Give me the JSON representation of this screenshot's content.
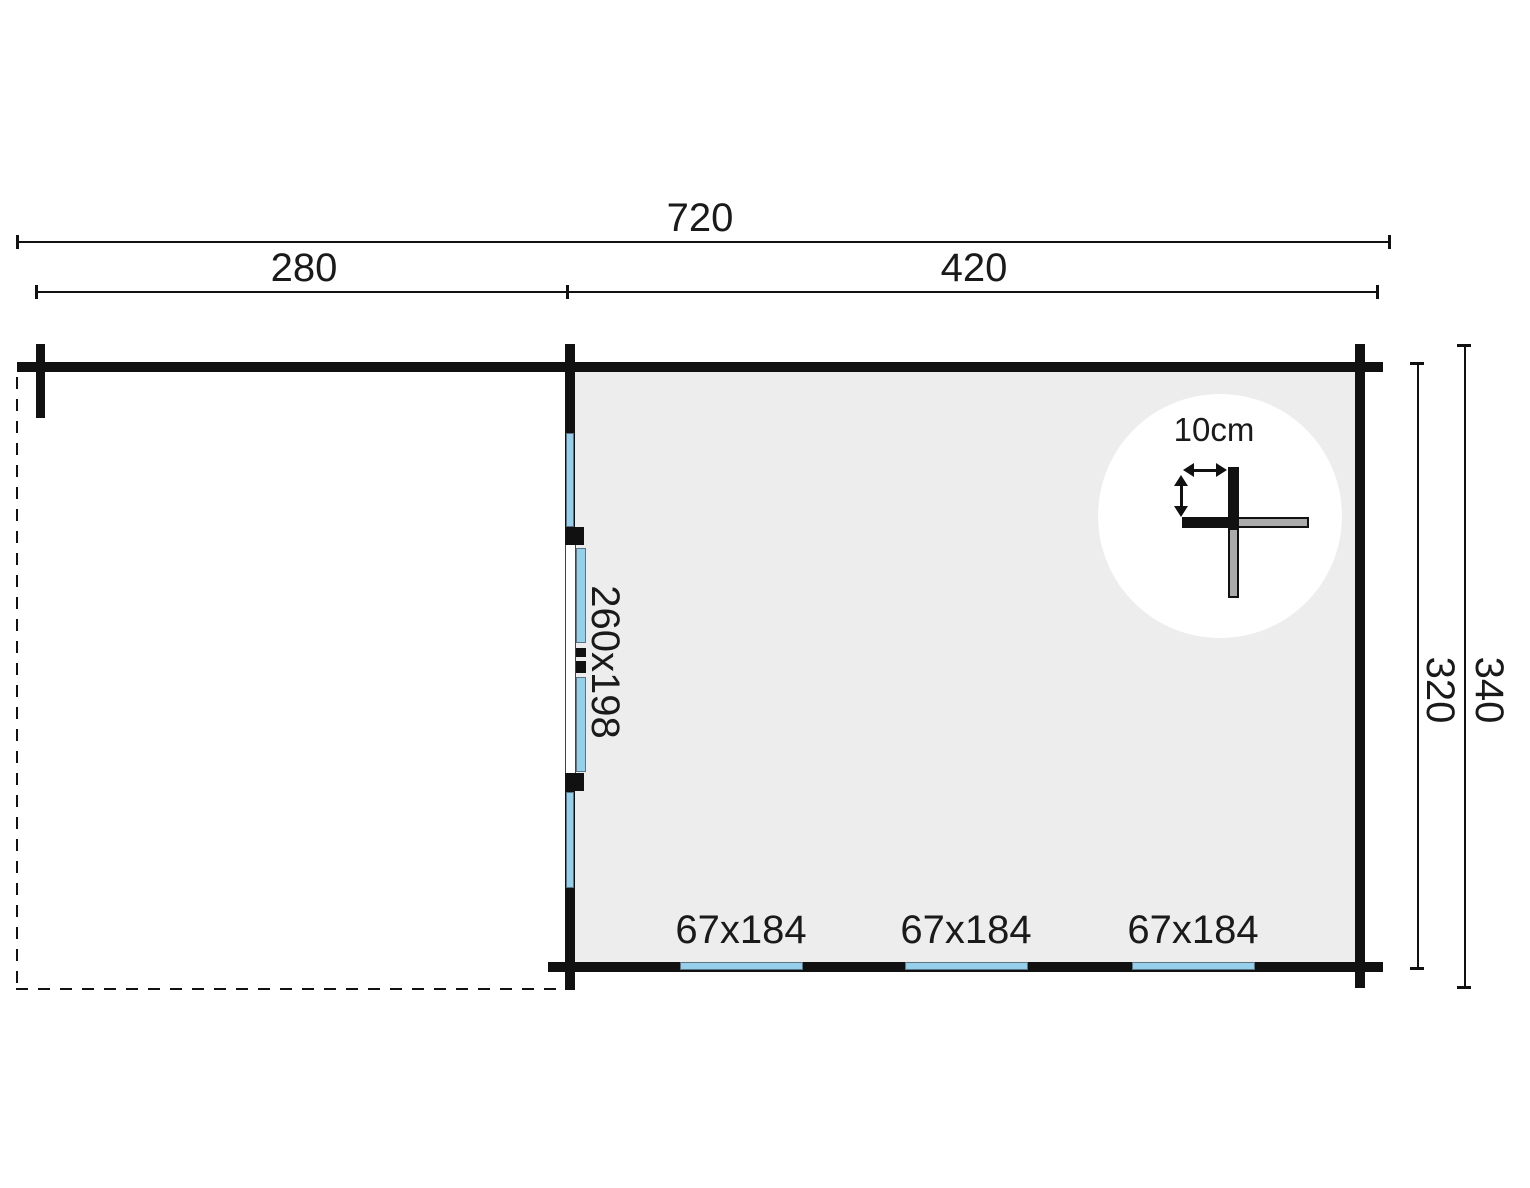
{
  "dims": {
    "total_width": "720",
    "left_section": "280",
    "right_section": "420",
    "inner_depth": "320",
    "outer_depth": "340"
  },
  "door": {
    "size": "260x198"
  },
  "windows": [
    {
      "size": "67x184"
    },
    {
      "size": "67x184"
    },
    {
      "size": "67x184"
    }
  ],
  "detail": {
    "wall_thickness": "10cm"
  },
  "colors": {
    "wall": "#111111",
    "room_fill": "#EDEDED",
    "glass_fill": "#95CFE9",
    "glass_outline": "#5A7483",
    "detail_gray": "#ABABAB"
  }
}
